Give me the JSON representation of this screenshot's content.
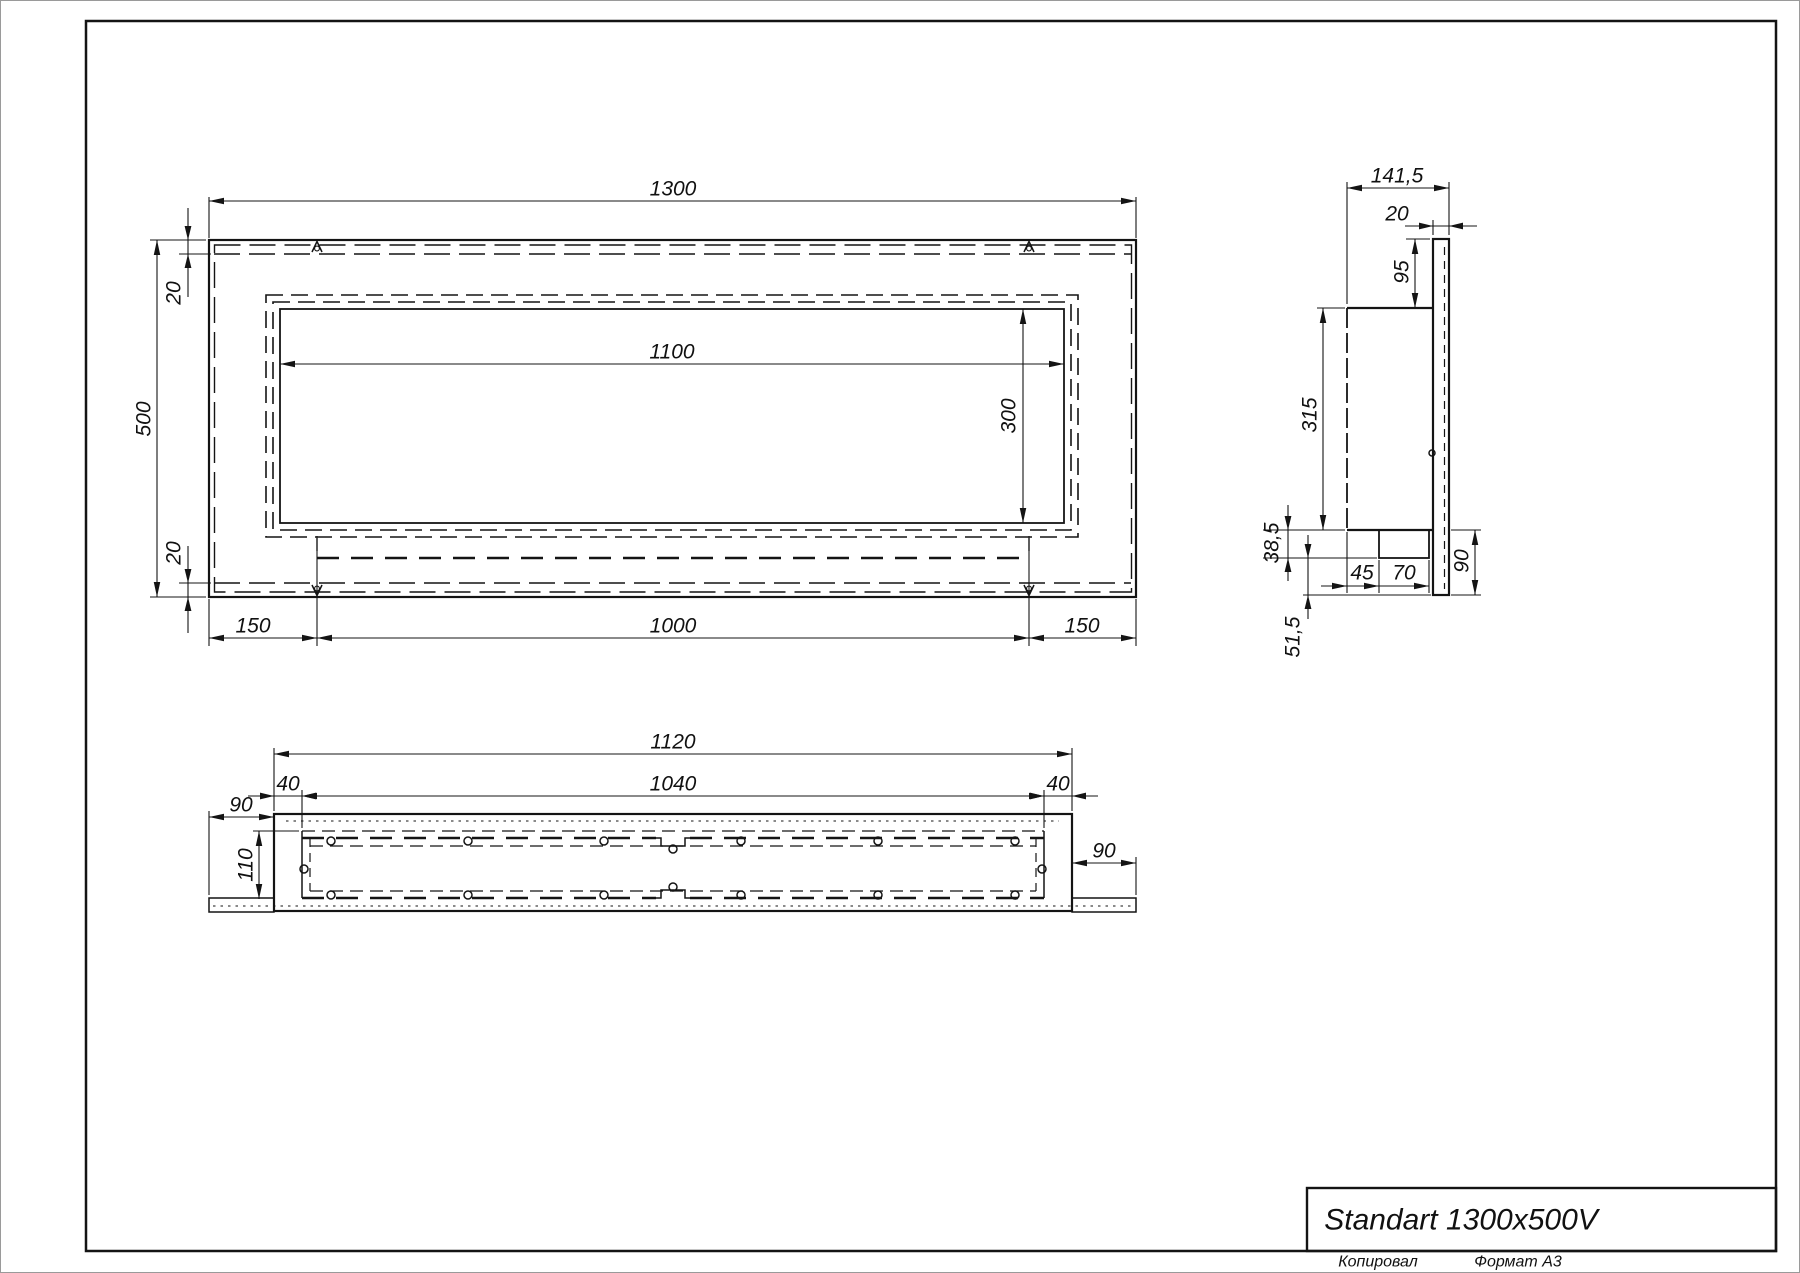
{
  "front": {
    "total_width": "1300",
    "total_height": "500",
    "top_inset": "20",
    "bottom_inset": "20",
    "opening_width": "1100",
    "opening_height": "300",
    "foot_left": "150",
    "foot_center": "1000",
    "foot_right": "150"
  },
  "side": {
    "total_depth": "141,5",
    "flange_thickness": "20",
    "flange_top_ext": "95",
    "body_height": "315",
    "tray_drop": "38,5",
    "tray_offset": "45",
    "tray_width": "70",
    "flange_bottom_ext": "90",
    "tray_to_flange": "51,5"
  },
  "top": {
    "body_width": "1120",
    "opening_width": "1040",
    "margin_left": "40",
    "margin_right": "40",
    "flange_ext_left": "90",
    "flange_ext_right": "90",
    "body_depth": "110"
  },
  "title_block": {
    "model": "Standart 1300x500V",
    "copied_label": "Копировал",
    "format_label": "Формат А3"
  }
}
